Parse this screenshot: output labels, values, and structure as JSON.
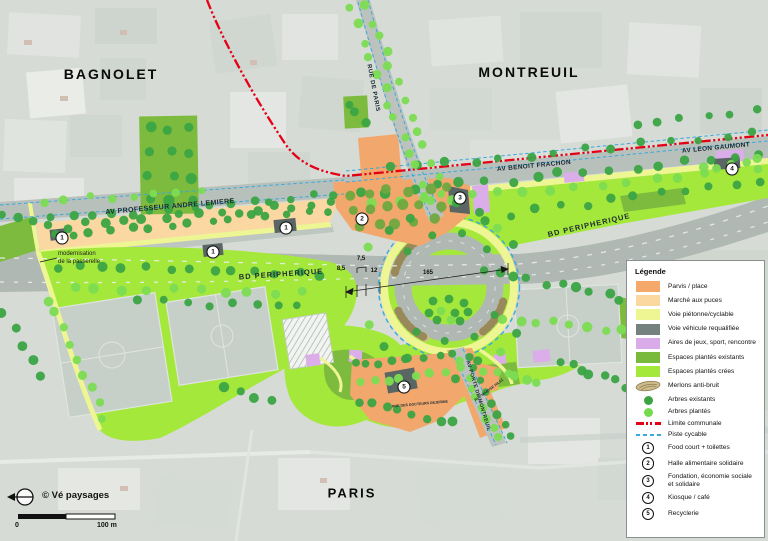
{
  "map": {
    "cities": [
      {
        "text": "BAGNOLET",
        "x": 111,
        "y": 74,
        "size": 14
      },
      {
        "text": "MONTREUIL",
        "x": 529,
        "y": 72,
        "size": 14
      },
      {
        "text": "PARIS",
        "x": 352,
        "y": 493,
        "size": 13
      }
    ],
    "road_labels": [
      {
        "text": "AV PROFESSEUR ANDRE LEMIERE",
        "x": 170,
        "y": 207,
        "rot": -5,
        "size": 7,
        "ls": 0.4
      },
      {
        "text": "BD PERIPHERIQUE",
        "x": 281,
        "y": 274,
        "rot": -4,
        "size": 7.5,
        "ls": 1
      },
      {
        "text": "BD PERIPHERIQUE",
        "x": 589,
        "y": 225,
        "rot": -13,
        "size": 7.5,
        "ls": 1
      },
      {
        "text": "AV BENOIT FRACHON",
        "x": 534,
        "y": 166,
        "rot": -5.5,
        "size": 6.5,
        "ls": 0.3
      },
      {
        "text": "AV LEON GAUMONT",
        "x": 716,
        "y": 148,
        "rot": -5.5,
        "size": 6.5,
        "ls": 0.3
      },
      {
        "text": "RUE DE PARIS",
        "x": 373,
        "y": 88,
        "rot": 79,
        "size": 6,
        "ls": 0.5
      },
      {
        "text": "AV PORTE DE MONTREUIL",
        "x": 478,
        "y": 396,
        "rot": 73,
        "size": 5.2,
        "ls": 0.3
      },
      {
        "text": "RUE DES DOCTEURS DEJERINE",
        "x": 420,
        "y": 404,
        "rot": -5,
        "size": 3.6,
        "ls": 0
      },
      {
        "text": "RUE MARYSE HILSZ",
        "x": 489,
        "y": 390,
        "rot": -37,
        "size": 3.6,
        "ls": 0
      }
    ],
    "annotation": {
      "line1": "modernisation",
      "line2": "de la passerelle",
      "x": 58,
      "y": 251
    },
    "dimensions": [
      {
        "text": "7,5",
        "x": 361,
        "y": 262
      },
      {
        "text": "8,5",
        "x": 341,
        "y": 272
      },
      {
        "text": "12",
        "x": 374,
        "y": 274
      },
      {
        "text": "165",
        "x": 428,
        "y": 276
      }
    ],
    "markers": [
      {
        "n": "1",
        "x": 62,
        "y": 238
      },
      {
        "n": "1",
        "x": 213,
        "y": 252
      },
      {
        "n": "1",
        "x": 286,
        "y": 228
      },
      {
        "n": "2",
        "x": 362,
        "y": 219
      },
      {
        "n": "3",
        "x": 460,
        "y": 198
      },
      {
        "n": "4",
        "x": 732,
        "y": 169
      },
      {
        "n": "5",
        "x": 404,
        "y": 387
      }
    ]
  },
  "legend": {
    "title": "Légende",
    "items": [
      {
        "type": "swatch",
        "color": "#F4A96B",
        "label": "Parvis / place"
      },
      {
        "type": "swatch",
        "color": "#FBD8A0",
        "label": "Marché aux puces"
      },
      {
        "type": "swatch",
        "color": "#EDF693",
        "label": "Voie piétonne/cyclable"
      },
      {
        "type": "swatch",
        "color": "#75817E",
        "label": "Voie véhicule requalifiée"
      },
      {
        "type": "swatch",
        "color": "#D9ABE9",
        "label": "Aires de jeux, sport, rencontre"
      },
      {
        "type": "swatch",
        "color": "#79B93C",
        "label": "Espaces plantés existants"
      },
      {
        "type": "swatch",
        "color": "#A3E83B",
        "label": "Espaces plantés crées"
      },
      {
        "type": "merlon",
        "label": "Merlons anti-bruit"
      },
      {
        "type": "dot",
        "color": "#3BA441",
        "label": "Arbres existants"
      },
      {
        "type": "dot",
        "color": "#74DB4F",
        "label": "Arbres plantés"
      },
      {
        "type": "line-red",
        "label": "Limite communale"
      },
      {
        "type": "line-blue",
        "label": "Piste cycable"
      },
      {
        "type": "num",
        "n": "1",
        "label": "Food court + toilettes"
      },
      {
        "type": "num",
        "n": "2",
        "label": "Halle alimentaire solidaire"
      },
      {
        "type": "num",
        "n": "3",
        "label": "Fondation, économie sociale et solidaire"
      },
      {
        "type": "num",
        "n": "4",
        "label": "Kiosque / café"
      },
      {
        "type": "num",
        "n": "5",
        "label": "Recyclerie"
      }
    ]
  },
  "footer": {
    "attribution": "© Vé paysages",
    "scale_zero": "0",
    "scale_label": "100 m"
  },
  "colors": {
    "parvis": "#F4A96B",
    "marche": "#FBD8A0",
    "voie_pietonne": "#EDF693",
    "voie_vehicule": "#75817E",
    "aires_jeux": "#D9ABE9",
    "plantes_existants": "#79B93C",
    "plantes_crees": "#A3E83B",
    "arbre_existant": "#3BA441",
    "arbre_plante": "#74DB4F",
    "limite_communale": "#E60015",
    "piste_cyclable": "#38A9DC"
  }
}
